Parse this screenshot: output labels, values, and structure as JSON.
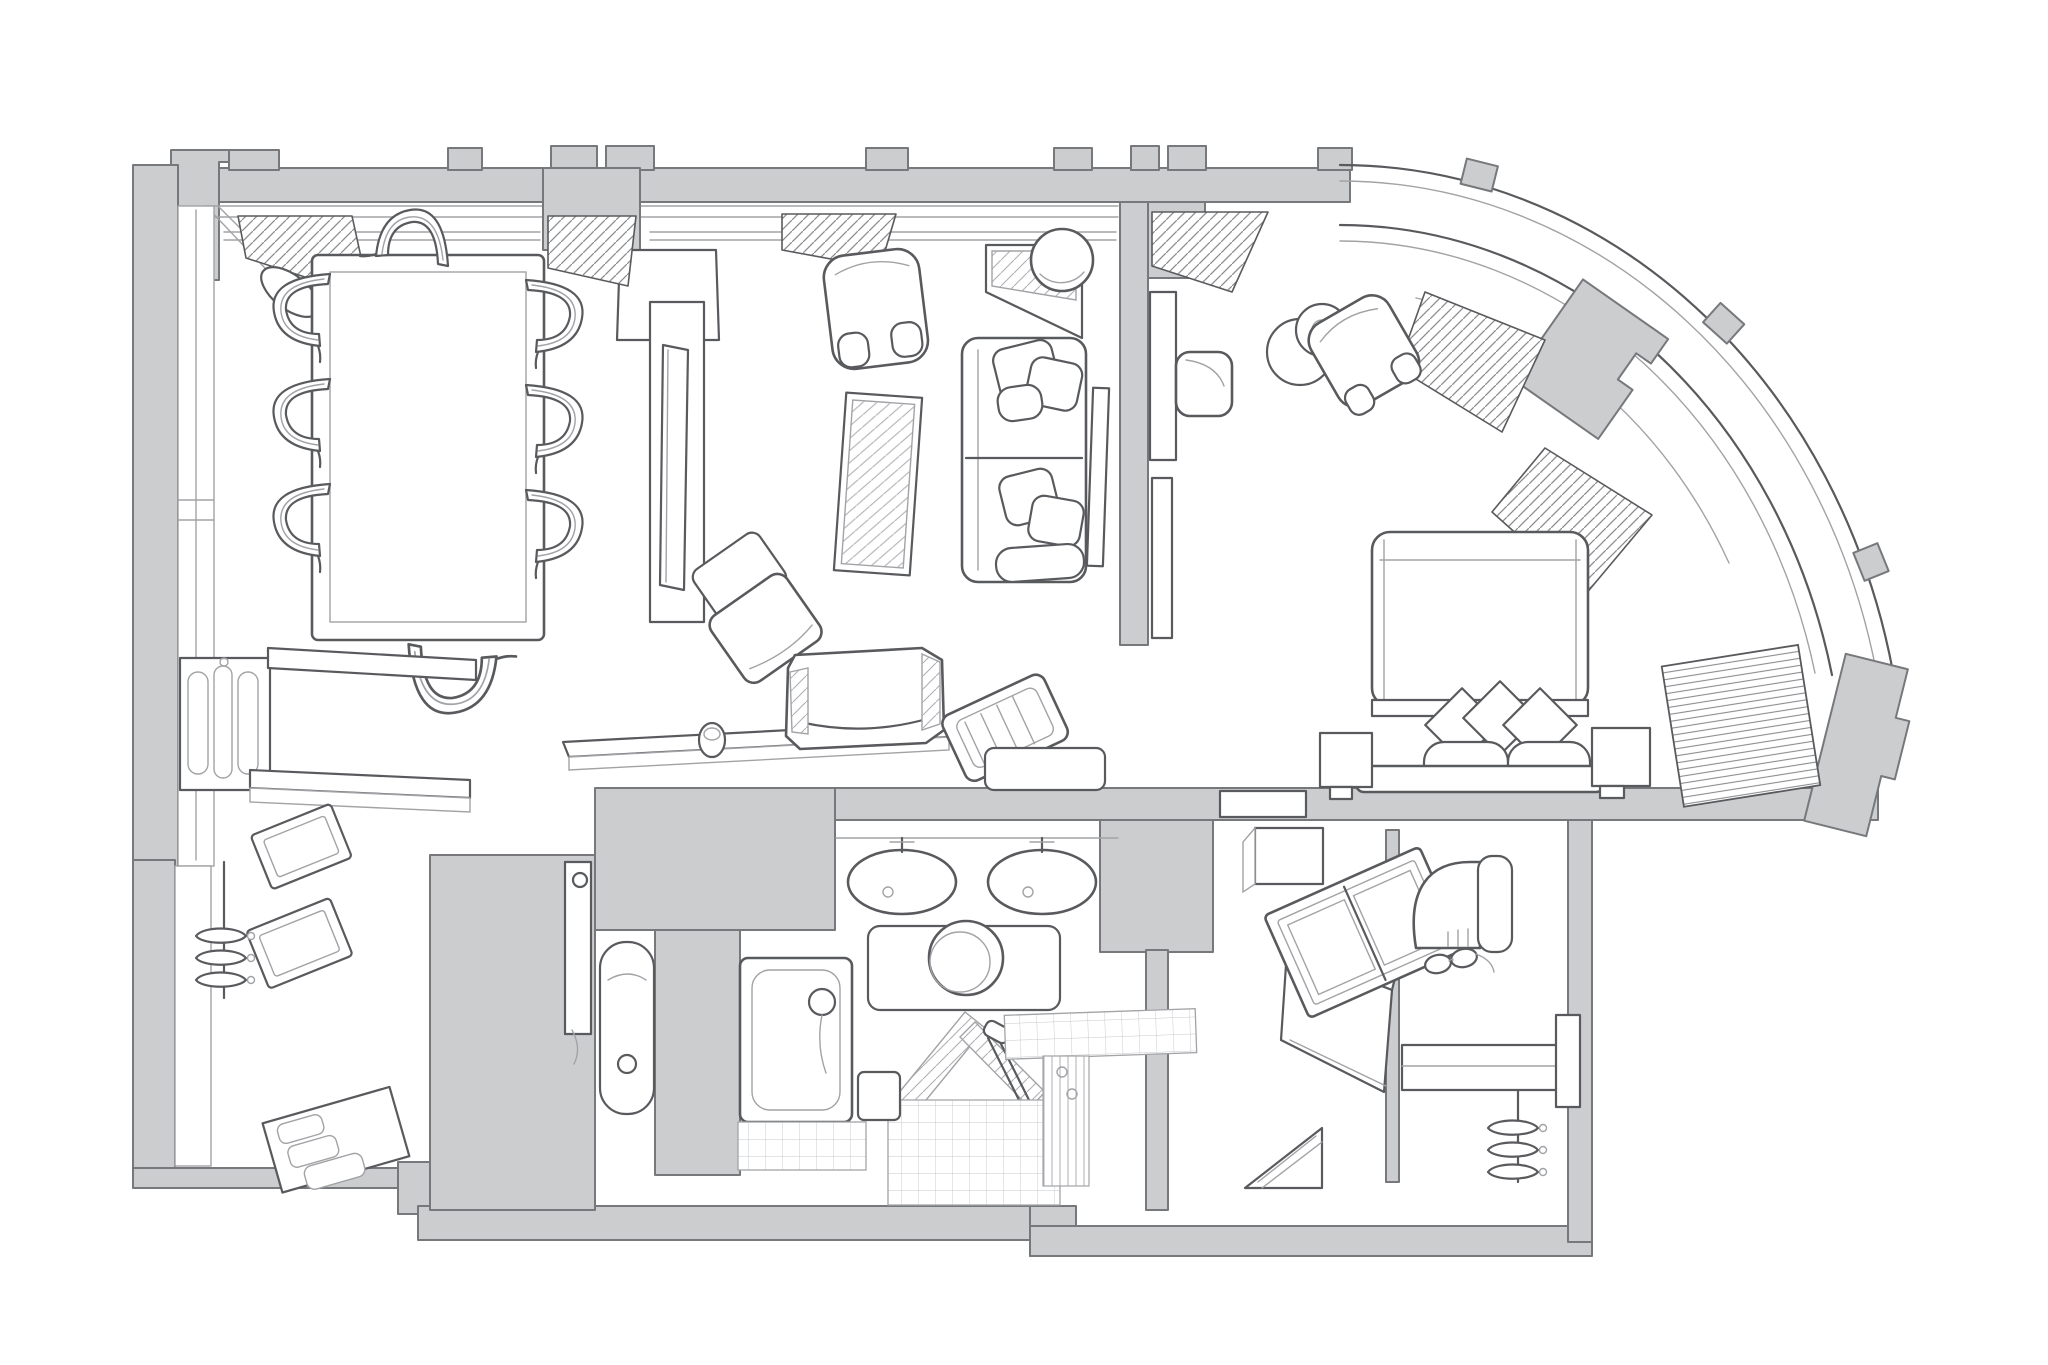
{
  "canvas": {
    "background": "#ffffff",
    "wall_fill": "#cbcdcf",
    "wall_stroke": "#77787b",
    "line_strong": "#595a5d",
    "line_light": "#a2a3a6",
    "tile_line": "#c6c7ca",
    "furniture_fill": "#ffffff"
  },
  "plan": {
    "label": "Hotel suite axonometric floor plan",
    "walls_label": "Walls and curved bay window"
  },
  "rooms": {
    "dining": {
      "label": "Dining room",
      "furniture": [
        "dining-table",
        "dining-chair (x8)",
        "wall-sconce",
        "sideboard",
        "console-shelf",
        "tall-mirror",
        "window-drapes"
      ]
    },
    "living": {
      "label": "Living room",
      "furniture": [
        "armchair",
        "glass-coffee-table",
        "sofa",
        "throw-pillows",
        "corner-console",
        "table-lamp",
        "slipper-chair",
        "wall-panel"
      ]
    },
    "hallway": {
      "label": "Hallway",
      "furniture": [
        "console-shelf",
        "vase",
        "tv-console",
        "luggage-bench"
      ]
    },
    "bedroom": {
      "label": "Bedroom",
      "furniture": [
        "bed",
        "pillows",
        "bolsters",
        "headboard",
        "nightstand (x2)",
        "tv-panel",
        "media-console",
        "armchair",
        "side-table",
        "table-lamp",
        "radiator",
        "window-drapes"
      ]
    },
    "entry": {
      "label": "Entry hall",
      "furniture": [
        "wall-rack (x2)",
        "coat-hangers",
        "hanging-rod",
        "shoe-mats",
        "entry-door"
      ]
    },
    "bathroom": {
      "label": "Bathroom",
      "furniture": [
        "double-sink-vanity",
        "toilet",
        "bidet",
        "bathtub",
        "hand-shower",
        "shower-glass",
        "shower-door-handle",
        "tiled-bench",
        "step-stool"
      ]
    },
    "dressing": {
      "label": "Dressing room",
      "furniture": [
        "vanity-desk",
        "folding-mirror",
        "eyeglasses",
        "desk-chair",
        "wall-cabinet",
        "closet-shelf",
        "coat-hangers",
        "luggage-rack",
        "wall-mirror"
      ]
    }
  }
}
